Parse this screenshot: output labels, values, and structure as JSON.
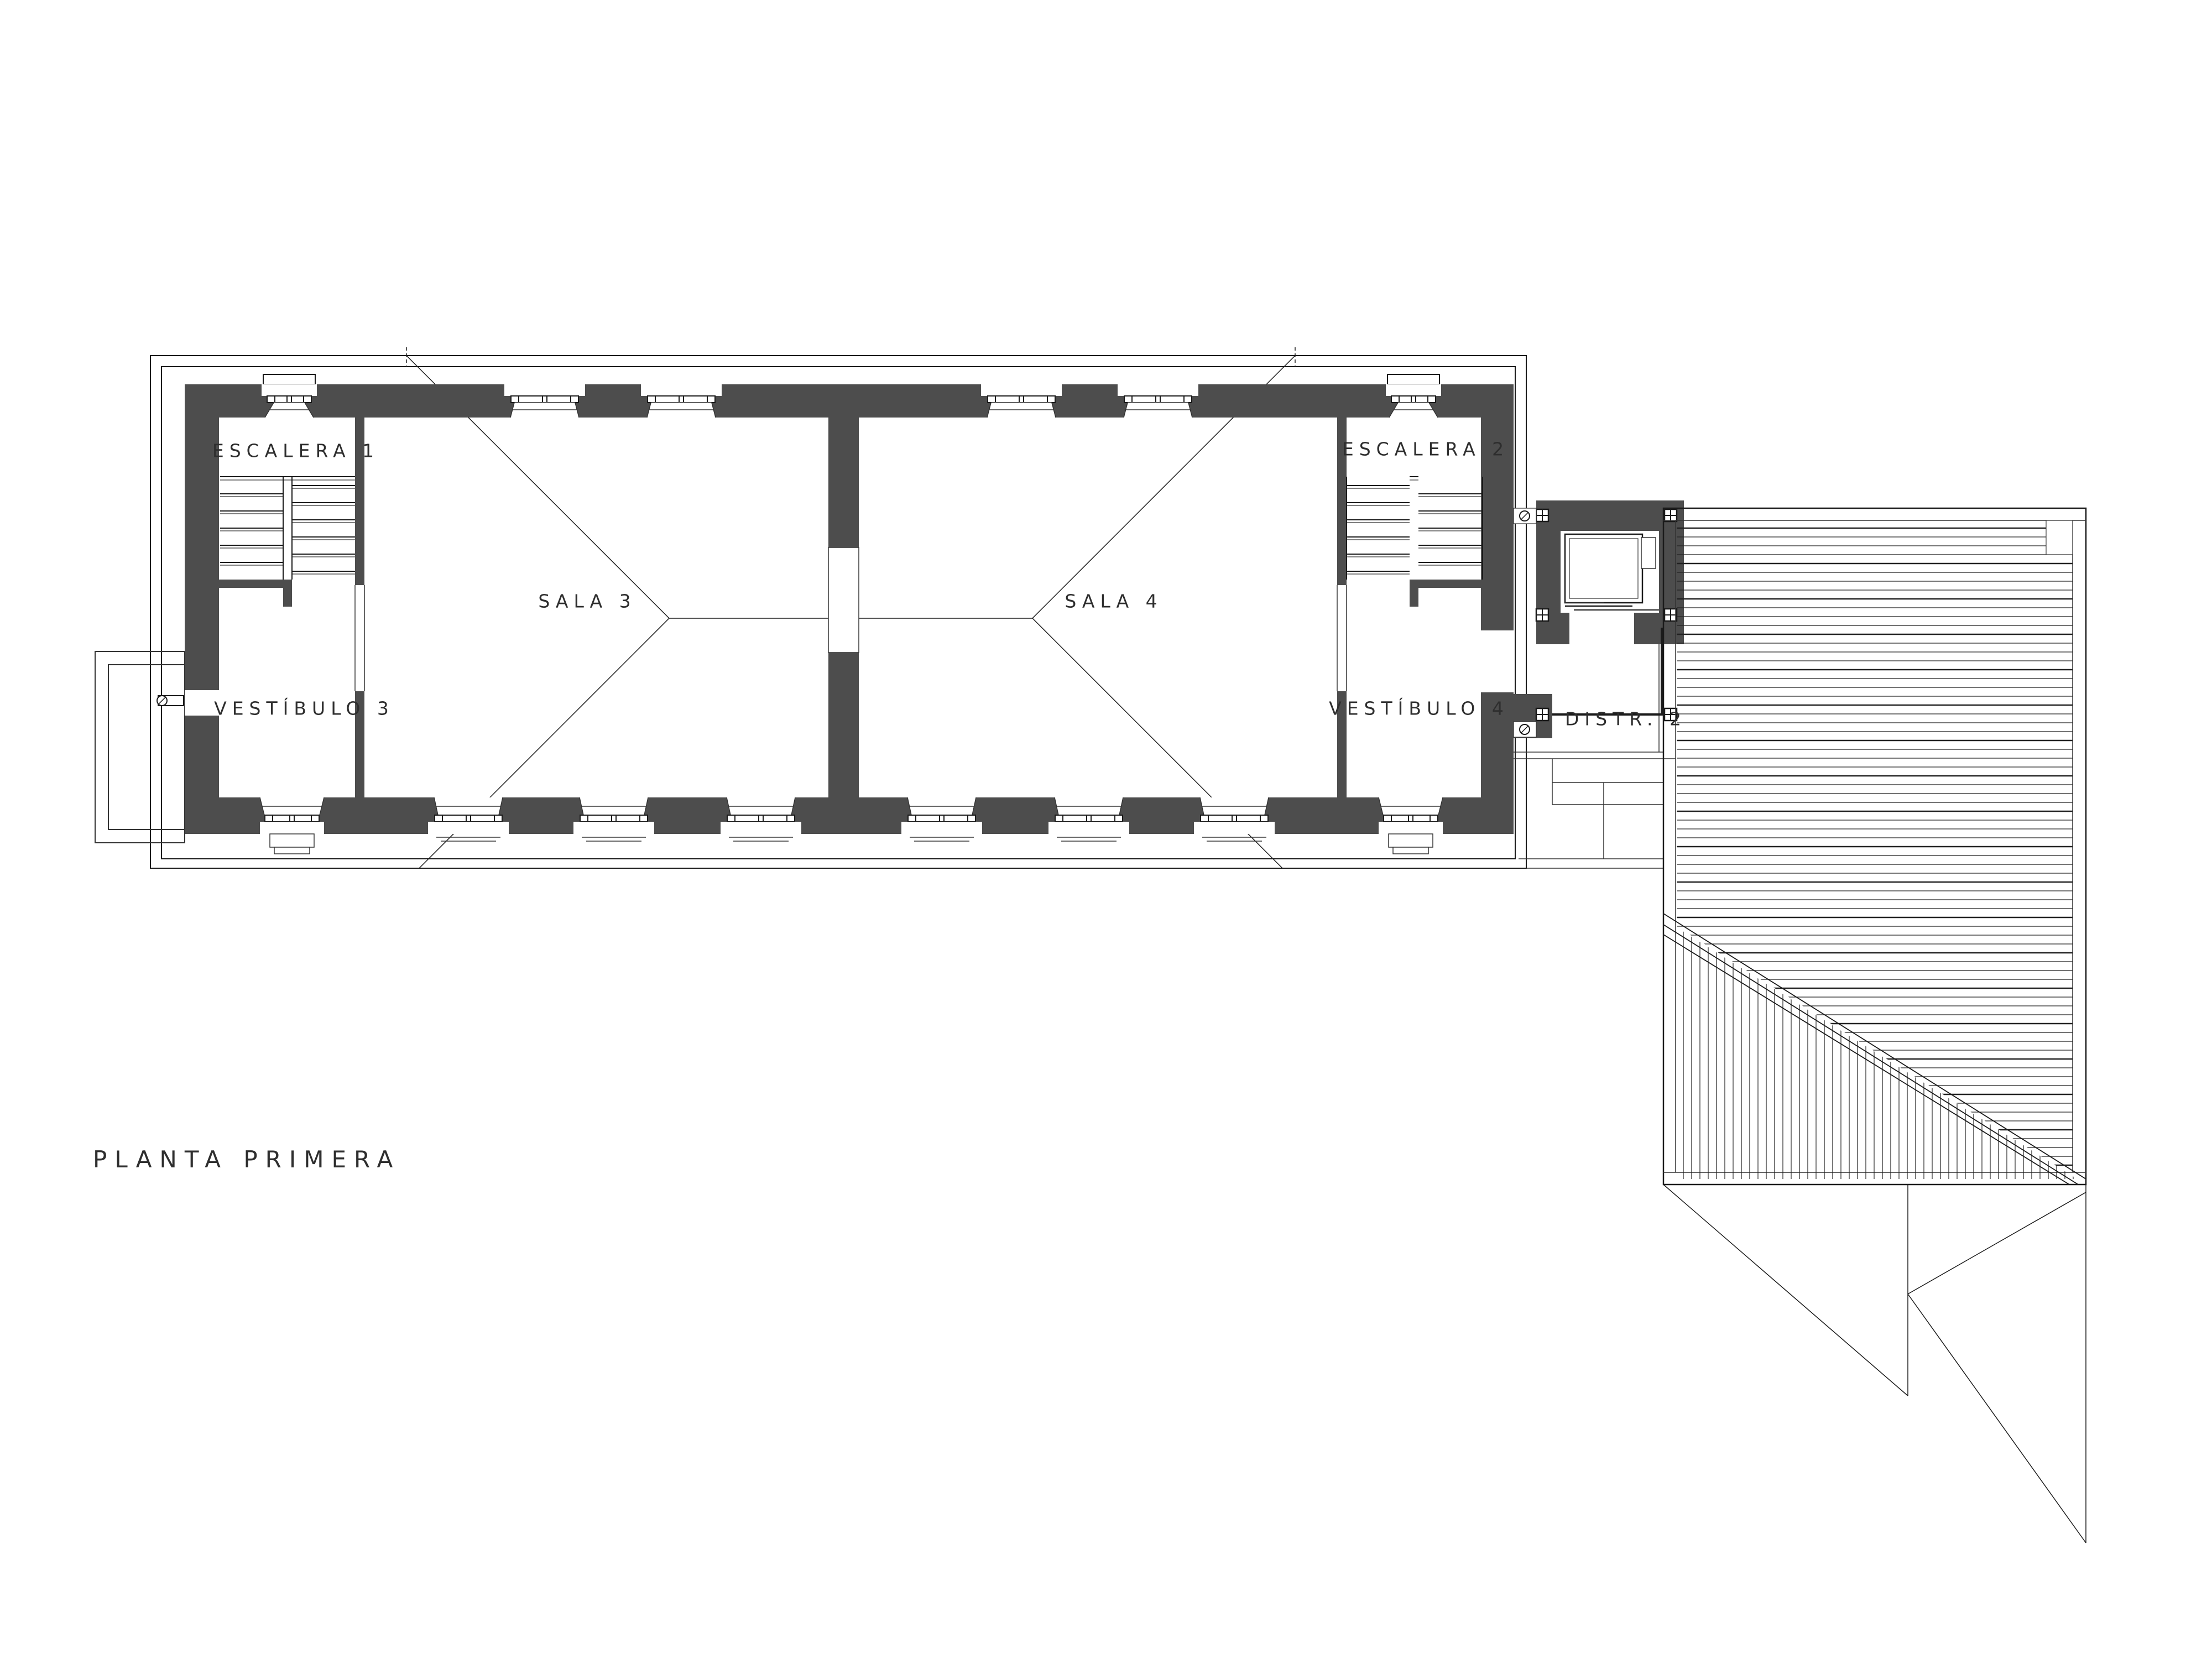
{
  "title": {
    "text": "PLANTA  PRIMERA"
  },
  "rooms": {
    "escalera1": {
      "label": "ESCALERA  1"
    },
    "escalera2": {
      "label": "ESCALERA  2"
    },
    "sala3": {
      "label": "SALA  3"
    },
    "sala4": {
      "label": "SALA  4"
    },
    "vestibulo3": {
      "label": "VESTÍBULO  3"
    },
    "vestibulo4": {
      "label": "VESTÍBULO  4"
    },
    "distr2": {
      "label": "DISTR.  2"
    }
  },
  "colors": {
    "wall": "#4d4d4d",
    "line": "#1a1a1a",
    "thin": "#333333",
    "text": "#2e2e2e"
  }
}
